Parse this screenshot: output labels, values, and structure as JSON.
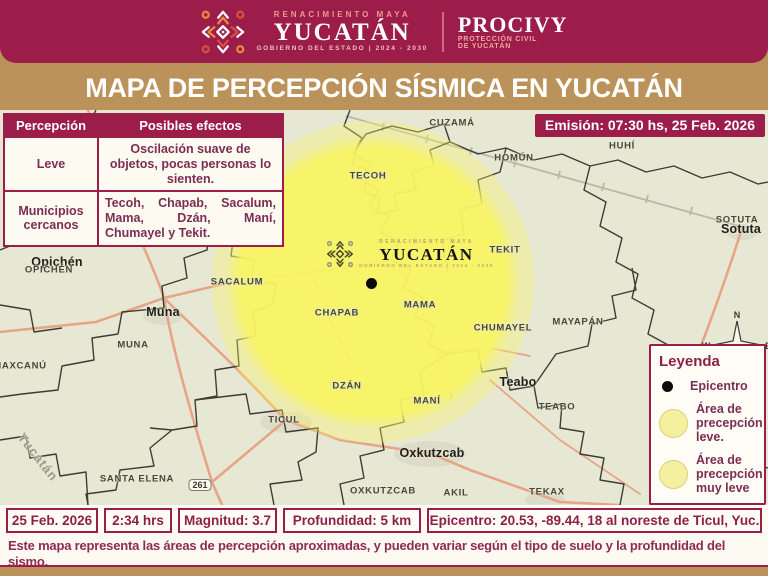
{
  "header": {
    "brand": {
      "renacimiento": "RENACIMIENTO MAYA",
      "yucatan": "YUCATÁN",
      "gobierno": "GOBIERNO DEL ESTADO  |  2024 - 2030",
      "procivy": "PROCIVY",
      "procivy_sub1": "PROTECCIÓN CIVIL",
      "procivy_sub2": "DE YUCATÁN"
    },
    "title": "MAPA DE PERCEPCIÓN SÍSMICA EN YUCATÁN"
  },
  "emision": "Emisión: 07:30 hs, 25 Feb. 2026",
  "perception_table": {
    "headers": [
      "Percepción",
      "Posibles efectos"
    ],
    "rows": [
      {
        "label": "Leve",
        "value": "Oscilación suave de objetos, pocas personas lo sienten."
      },
      {
        "label": "Municipios cercanos",
        "value": "Tecoh, Chapab, Sacalum, Mama, Dzán, Maní, Chumayel y Tekit."
      }
    ]
  },
  "legend": {
    "title": "Leyenda",
    "items": [
      {
        "swatch": "black-dot",
        "label": "Epicentro"
      },
      {
        "swatch": "yellow-circle",
        "label": "Área de precepción leve."
      },
      {
        "swatch": "yellow-circle",
        "label": "Área de precepción muy leve"
      }
    ]
  },
  "map": {
    "watermark": {
      "top": "RENACIMIENTO MAYA",
      "name": "YUCATÁN",
      "bottom": "GOBIERNO DEL ESTADO | 2024 - 2030"
    },
    "state_watermark": "Yucatán",
    "highway_shield": "261",
    "compass": {
      "n": "N",
      "e": "E",
      "w": "W",
      "s": "S"
    },
    "labels": [
      {
        "text": "CUZAMÁ",
        "x": 452,
        "y": 13,
        "cls": "m"
      },
      {
        "text": "HOMÚN",
        "x": 514,
        "y": 48,
        "cls": "m"
      },
      {
        "text": "HUHÍ",
        "x": 622,
        "y": 36,
        "cls": "m"
      },
      {
        "text": "TECOH",
        "x": 368,
        "y": 66,
        "cls": "m"
      },
      {
        "text": "SOTUTA",
        "x": 737,
        "y": 110,
        "cls": "m"
      },
      {
        "text": "Sotuta",
        "x": 741,
        "y": 119,
        "cls": "t"
      },
      {
        "text": "TEKIT",
        "x": 505,
        "y": 140,
        "cls": "m"
      },
      {
        "text": "Opichén",
        "x": 57,
        "y": 152,
        "cls": "t"
      },
      {
        "text": "OPICHÉN",
        "x": 49,
        "y": 160,
        "cls": "m"
      },
      {
        "text": "SACALUM",
        "x": 237,
        "y": 172,
        "cls": "m"
      },
      {
        "text": "MAMA",
        "x": 420,
        "y": 195,
        "cls": "m"
      },
      {
        "text": "CHAPAB",
        "x": 337,
        "y": 203,
        "cls": "m"
      },
      {
        "text": "MAYAPÁN",
        "x": 578,
        "y": 212,
        "cls": "m"
      },
      {
        "text": "CHUMAYEL",
        "x": 503,
        "y": 218,
        "cls": "m"
      },
      {
        "text": "Muna",
        "x": 163,
        "y": 202,
        "cls": "t"
      },
      {
        "text": "MUNA",
        "x": 133,
        "y": 235,
        "cls": "m"
      },
      {
        "text": "MAXCANÚ",
        "x": 20,
        "y": 256,
        "cls": "m"
      },
      {
        "text": "DZÁN",
        "x": 347,
        "y": 276,
        "cls": "m"
      },
      {
        "text": "MANÍ",
        "x": 427,
        "y": 291,
        "cls": "m"
      },
      {
        "text": "Teabo",
        "x": 518,
        "y": 272,
        "cls": "t"
      },
      {
        "text": "TEABO",
        "x": 557,
        "y": 297,
        "cls": "m"
      },
      {
        "text": "TICUL",
        "x": 284,
        "y": 310,
        "cls": "m"
      },
      {
        "text": "Oxkutzcab",
        "x": 432,
        "y": 343,
        "cls": "t"
      },
      {
        "text": "SANTA ELENA",
        "x": 137,
        "y": 369,
        "cls": "m"
      },
      {
        "text": "OXKUTZCAB",
        "x": 383,
        "y": 381,
        "cls": "m"
      },
      {
        "text": "AKIL",
        "x": 456,
        "y": 383,
        "cls": "m"
      },
      {
        "text": "TEKAX",
        "x": 547,
        "y": 382,
        "cls": "m"
      },
      {
        "text": "Yucatán",
        "x": 38,
        "y": 347,
        "cls": "wm-rot",
        "rot": 52
      },
      {
        "text": "261",
        "x": 200,
        "y": 375,
        "cls": "shield"
      }
    ]
  },
  "footer": {
    "cells": [
      "25 Feb. 2026",
      "2:34 hrs",
      "Magnitud: 3.7",
      "Profundidad:  5 km",
      "Epicentro: 20.53, -89.44,  18 al noreste de Ticul, Yuc."
    ],
    "disclaimer_line1": "Este mapa representa las áreas de percepción aproximadas, y pueden variar según el tipo de suelo y la profundidad del sismo.",
    "disclaimer_line2": "Los radios indican las zonas donde fue posible sentirlo; mientras más cerca del epicentro, mayor puede ser la intensidad percibida."
  },
  "colors": {
    "maroon": "#9c1c4a",
    "gold": "#bb9259",
    "map_background": "#e7e8d3",
    "perception_yellow": "#f8f464",
    "plum_text": "#7c2d52",
    "road_salmon": "#e8a183"
  }
}
